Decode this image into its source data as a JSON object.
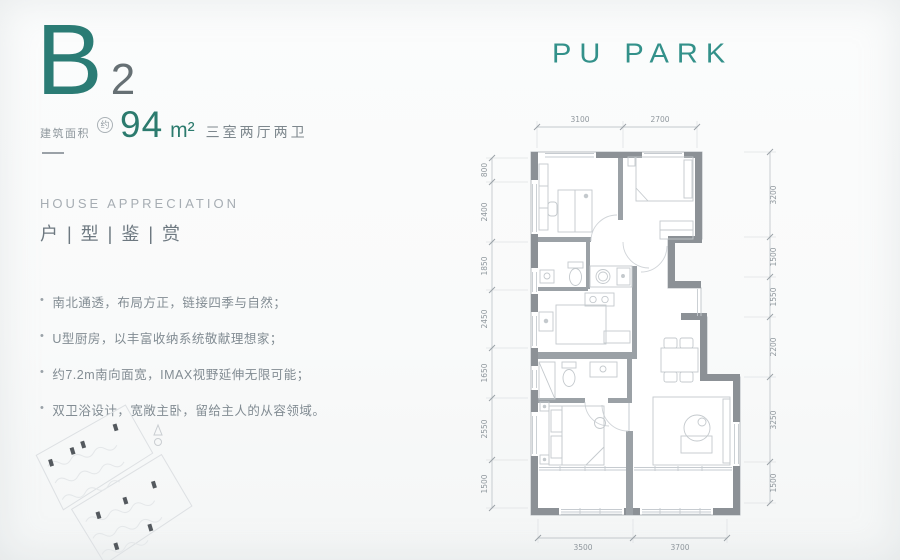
{
  "brand": {
    "logo": "PU PARK",
    "accent": "#2E837C",
    "logo_color": "#33918A"
  },
  "unit": {
    "code_letter": "B",
    "code_number": "2",
    "area_label": "建筑面积",
    "area_approx_badge": "约",
    "area_value": "94",
    "area_unit": "m²",
    "layout_text": "三室两厅两卫"
  },
  "section": {
    "subtitle_en": "HOUSE APPRECIATION",
    "title_cn": "户 | 型 | 鉴 | 赏"
  },
  "features": [
    "南北通透，布局方正，链接四季与自然；",
    "U型厨房，以丰富收纳系统敬献理想家；",
    "约7.2m南向面宽，IMAX视野延伸无限可能；",
    "双卫浴设计，宽敞主卧，留给主人的从容领域。"
  ],
  "plan": {
    "dims_top": [
      "3100",
      "2700"
    ],
    "dims_bottom": [
      "3500",
      "3700"
    ],
    "dims_left": [
      "800",
      "2400",
      "1850",
      "2450",
      "1650",
      "2550",
      "1500"
    ],
    "dims_right": [
      "3200",
      "1500",
      "1550",
      "2200",
      "3250",
      "1500"
    ],
    "wall_color": "#8C9196",
    "dim_text_color": "#8F979D"
  }
}
